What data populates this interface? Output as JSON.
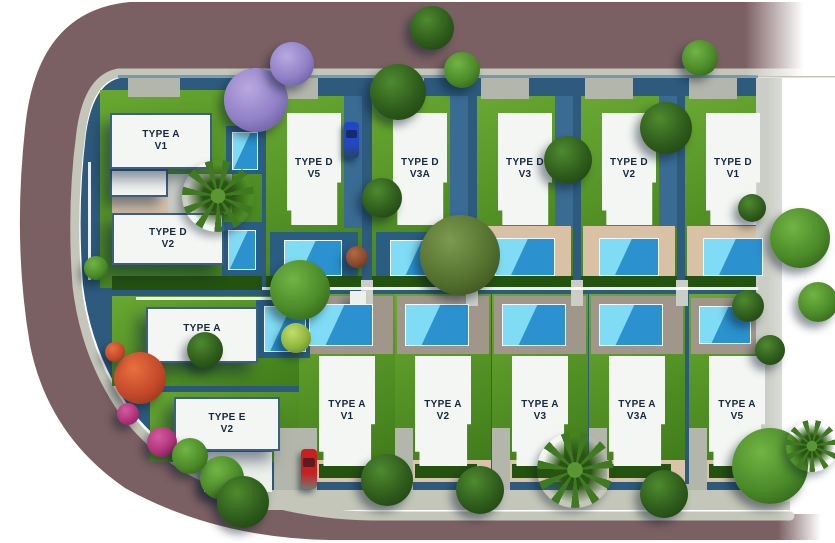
{
  "scene": {
    "width": 835,
    "height": 543,
    "colors": {
      "road": "#7b6063",
      "curb": "#c3c6b9",
      "parcel": "#2d5a7d",
      "lawn_light": "#69a832",
      "lawn_dark": "#3f7c1a",
      "hedge": "#24520f",
      "deckDark": "#2a5d82",
      "deckBeige": "#d8c1a5",
      "deckTaupe": "#a1968a",
      "sand": "#d9c4aa",
      "path": "#b3b7ab",
      "pathLight": "#cbcec6",
      "sidewalk": "#c3c6b9",
      "sidestrip": "#3a6b93",
      "pool_light": "#7fdcf4",
      "pool_deep": "#2b92cf",
      "fence": "#ffffff",
      "highlight": "#5f8aa9",
      "annex": "#eef0ec",
      "roof": "#f4f6f4",
      "roof_outline": "#3c607f",
      "label_text": "#16293c"
    },
    "tree_palettes": {
      "dark": {
        "light": "#4e8a2e",
        "base": "#2e5c1c",
        "deep": "#1d3f10"
      },
      "mid": {
        "light": "#72b445",
        "base": "#4b8a28",
        "deep": "#2c5a14"
      },
      "olive": {
        "light": "#7d9a4f",
        "base": "#55712f",
        "deep": "#36491c"
      },
      "yellow": {
        "light": "#c2dd6e",
        "base": "#8fb63a",
        "deep": "#5d7c1f"
      },
      "purple": {
        "light": "#b9a9e0",
        "base": "#8f7fc6",
        "deep": "#5e5390"
      },
      "redorange": {
        "light": "#e8703f",
        "base": "#c4492a",
        "deep": "#8a2f1a"
      },
      "magenta": {
        "light": "#d45ba1",
        "base": "#b0337a",
        "deep": "#7a1f53"
      },
      "redbrown": {
        "light": "#b06a43",
        "base": "#8a4a2e",
        "deep": "#5c2e1a"
      },
      "palm": {
        "light": "#5c9633",
        "base": "#3f7a22",
        "deep": "#2a5413"
      }
    }
  },
  "villas": [
    {
      "id": "a-v1-nw",
      "l1": "TYPE A",
      "l2": "V1",
      "x": 110,
      "y": 113,
      "w": 102,
      "h": 56,
      "outlined": true,
      "wing": {
        "x": 110,
        "y": 169,
        "w": 58,
        "h": 28
      }
    },
    {
      "id": "d-v2-w",
      "l1": "TYPE D",
      "l2": "V2",
      "x": 112,
      "y": 213,
      "w": 112,
      "h": 52,
      "outlined": true
    },
    {
      "id": "a-v1-w",
      "l1": "TYPE A",
      "l2": "V1",
      "x": 146,
      "y": 307,
      "w": 112,
      "h": 56,
      "outlined": true
    },
    {
      "id": "e-v2",
      "l1": "TYPE E",
      "l2": "V2",
      "x": 174,
      "y": 397,
      "w": 106,
      "h": 54,
      "outlined": true
    },
    {
      "id": "d-v5",
      "l1": "TYPE D",
      "l2": "V5",
      "x": 287,
      "y": 113,
      "w": 54,
      "h": 112,
      "clip": "top"
    },
    {
      "id": "d-v3a",
      "l1": "TYPE D",
      "l2": "V3A",
      "x": 393,
      "y": 113,
      "w": 54,
      "h": 112,
      "clip": "top"
    },
    {
      "id": "d-v3",
      "l1": "TYPE D",
      "l2": "V3",
      "x": 498,
      "y": 113,
      "w": 54,
      "h": 112,
      "clip": "top"
    },
    {
      "id": "d-v2",
      "l1": "TYPE D",
      "l2": "V2",
      "x": 602,
      "y": 113,
      "w": 54,
      "h": 112,
      "clip": "top"
    },
    {
      "id": "d-v1",
      "l1": "TYPE D",
      "l2": "V1",
      "x": 706,
      "y": 113,
      "w": 54,
      "h": 112,
      "clip": "top"
    },
    {
      "id": "a-v1-s",
      "l1": "TYPE A",
      "l2": "V1",
      "x": 319,
      "y": 356,
      "w": 56,
      "h": 110,
      "clip": "bottom"
    },
    {
      "id": "a-v2",
      "l1": "TYPE A",
      "l2": "V2",
      "x": 415,
      "y": 356,
      "w": 56,
      "h": 110,
      "clip": "bottom"
    },
    {
      "id": "a-v3",
      "l1": "TYPE A",
      "l2": "V3",
      "x": 512,
      "y": 356,
      "w": 56,
      "h": 110,
      "clip": "bottom"
    },
    {
      "id": "a-v3a",
      "l1": "TYPE A",
      "l2": "V3A",
      "x": 609,
      "y": 356,
      "w": 56,
      "h": 110,
      "clip": "bottom"
    },
    {
      "id": "a-v5",
      "l1": "TYPE A",
      "l2": "V5",
      "x": 709,
      "y": 356,
      "w": 56,
      "h": 110,
      "clip": "bottom"
    }
  ],
  "rects": [
    {
      "k": "lawn",
      "x": 100,
      "y": 90,
      "w": 162,
      "h": 198
    },
    {
      "k": "lawn",
      "x": 266,
      "y": 96,
      "w": 96,
      "h": 192
    },
    {
      "k": "lawn",
      "x": 372,
      "y": 96,
      "w": 96,
      "h": 192
    },
    {
      "k": "lawn",
      "x": 477,
      "y": 96,
      "w": 96,
      "h": 192
    },
    {
      "k": "lawn",
      "x": 581,
      "y": 96,
      "w": 96,
      "h": 192
    },
    {
      "k": "lawn",
      "x": 685,
      "y": 96,
      "w": 96,
      "h": 192
    },
    {
      "k": "lawn",
      "x": 112,
      "y": 296,
      "w": 198,
      "h": 90
    },
    {
      "k": "lawn",
      "x": 150,
      "y": 392,
      "w": 160,
      "h": 70
    },
    {
      "k": "lawn",
      "x": 299,
      "y": 294,
      "w": 96,
      "h": 170
    },
    {
      "k": "lawn",
      "x": 395,
      "y": 294,
      "w": 96,
      "h": 170
    },
    {
      "k": "lawn",
      "x": 492,
      "y": 294,
      "w": 96,
      "h": 170
    },
    {
      "k": "lawn",
      "x": 589,
      "y": 294,
      "w": 96,
      "h": 170
    },
    {
      "k": "lawn",
      "x": 689,
      "y": 294,
      "w": 92,
      "h": 170
    },
    {
      "k": "sand",
      "x": 112,
      "y": 172,
      "w": 56,
      "h": 42
    },
    {
      "k": "pathLight",
      "x": 168,
      "y": 174,
      "w": 64,
      "h": 40
    },
    {
      "k": "sidestrip",
      "x": 344,
      "y": 96,
      "w": 18,
      "h": 132
    },
    {
      "k": "sidestrip",
      "x": 450,
      "y": 96,
      "w": 18,
      "h": 132
    },
    {
      "k": "sidestrip",
      "x": 555,
      "y": 96,
      "w": 18,
      "h": 132
    },
    {
      "k": "sidestrip",
      "x": 659,
      "y": 96,
      "w": 18,
      "h": 132
    },
    {
      "k": "deckDark",
      "x": 270,
      "y": 232,
      "w": 88,
      "h": 52
    },
    {
      "k": "deckDark",
      "x": 376,
      "y": 232,
      "w": 88,
      "h": 52
    },
    {
      "k": "deckBeige",
      "x": 479,
      "y": 226,
      "w": 92,
      "h": 60
    },
    {
      "k": "deckBeige",
      "x": 583,
      "y": 226,
      "w": 92,
      "h": 60
    },
    {
      "k": "deckBeige",
      "x": 687,
      "y": 226,
      "w": 92,
      "h": 60
    },
    {
      "k": "deckTaupe",
      "x": 301,
      "y": 296,
      "w": 92,
      "h": 58
    },
    {
      "k": "deckTaupe",
      "x": 397,
      "y": 296,
      "w": 92,
      "h": 58
    },
    {
      "k": "deckTaupe",
      "x": 494,
      "y": 296,
      "w": 92,
      "h": 58
    },
    {
      "k": "deckTaupe",
      "x": 591,
      "y": 296,
      "w": 92,
      "h": 58
    },
    {
      "k": "deckTaupe",
      "x": 691,
      "y": 298,
      "w": 88,
      "h": 56
    },
    {
      "k": "deckDark",
      "x": 226,
      "y": 126,
      "w": 36,
      "h": 48
    },
    {
      "k": "deckDark",
      "x": 222,
      "y": 222,
      "w": 40,
      "h": 54
    },
    {
      "k": "deckDark",
      "x": 256,
      "y": 300,
      "w": 54,
      "h": 58
    },
    {
      "k": "sand",
      "x": 299,
      "y": 460,
      "w": 96,
      "h": 22
    },
    {
      "k": "sand",
      "x": 395,
      "y": 460,
      "w": 96,
      "h": 22
    },
    {
      "k": "sand",
      "x": 492,
      "y": 460,
      "w": 96,
      "h": 22
    },
    {
      "k": "sand",
      "x": 589,
      "y": 460,
      "w": 96,
      "h": 22
    },
    {
      "k": "sand",
      "x": 689,
      "y": 460,
      "w": 92,
      "h": 22
    },
    {
      "k": "hedge",
      "x": 266,
      "y": 276,
      "w": 96,
      "h": 14
    },
    {
      "k": "hedge",
      "x": 372,
      "y": 276,
      "w": 96,
      "h": 14
    },
    {
      "k": "hedge",
      "x": 477,
      "y": 276,
      "w": 96,
      "h": 14
    },
    {
      "k": "hedge",
      "x": 581,
      "y": 276,
      "w": 96,
      "h": 14
    },
    {
      "k": "hedge",
      "x": 685,
      "y": 276,
      "w": 96,
      "h": 14
    },
    {
      "k": "hedge",
      "x": 112,
      "y": 276,
      "w": 150,
      "h": 14
    },
    {
      "k": "hedge",
      "x": 319,
      "y": 464,
      "w": 62,
      "h": 14
    },
    {
      "k": "hedge",
      "x": 415,
      "y": 464,
      "w": 62,
      "h": 14
    },
    {
      "k": "hedge",
      "x": 512,
      "y": 464,
      "w": 62,
      "h": 14
    },
    {
      "k": "hedge",
      "x": 609,
      "y": 464,
      "w": 62,
      "h": 14
    },
    {
      "k": "hedge",
      "x": 709,
      "y": 464,
      "w": 58,
      "h": 14
    },
    {
      "k": "path",
      "x": 270,
      "y": 77,
      "w": 48,
      "h": 22
    },
    {
      "k": "path",
      "x": 376,
      "y": 77,
      "w": 48,
      "h": 22
    },
    {
      "k": "path",
      "x": 481,
      "y": 77,
      "w": 48,
      "h": 22
    },
    {
      "k": "path",
      "x": 585,
      "y": 77,
      "w": 48,
      "h": 22
    },
    {
      "k": "path",
      "x": 689,
      "y": 77,
      "w": 48,
      "h": 22
    },
    {
      "k": "path",
      "x": 128,
      "y": 77,
      "w": 52,
      "h": 20
    },
    {
      "k": "pathLight",
      "x": 361,
      "y": 280,
      "w": 12,
      "h": 26
    },
    {
      "k": "pathLight",
      "x": 466,
      "y": 280,
      "w": 12,
      "h": 26
    },
    {
      "k": "pathLight",
      "x": 571,
      "y": 280,
      "w": 12,
      "h": 26
    },
    {
      "k": "pathLight",
      "x": 676,
      "y": 280,
      "w": 12,
      "h": 26
    },
    {
      "k": "path",
      "x": 385,
      "y": 484,
      "w": 20,
      "h": 10
    },
    {
      "k": "path",
      "x": 482,
      "y": 484,
      "w": 20,
      "h": 10
    },
    {
      "k": "path",
      "x": 579,
      "y": 484,
      "w": 20,
      "h": 10
    },
    {
      "k": "path",
      "x": 676,
      "y": 484,
      "w": 20,
      "h": 10
    },
    {
      "k": "path",
      "x": 299,
      "y": 428,
      "w": 18,
      "h": 76
    },
    {
      "k": "path",
      "x": 395,
      "y": 428,
      "w": 18,
      "h": 76
    },
    {
      "k": "path",
      "x": 492,
      "y": 428,
      "w": 18,
      "h": 76
    },
    {
      "k": "path",
      "x": 589,
      "y": 428,
      "w": 18,
      "h": 76
    },
    {
      "k": "path",
      "x": 689,
      "y": 428,
      "w": 18,
      "h": 76
    },
    {
      "k": "path",
      "x": 274,
      "y": 428,
      "w": 32,
      "h": 76
    },
    {
      "k": "pathLight",
      "x": 756,
      "y": 78,
      "w": 26,
      "h": 430
    },
    {
      "k": "sidewalk",
      "x": 258,
      "y": 490,
      "w": 532,
      "h": 20
    },
    {
      "k": "annex",
      "x": 204,
      "y": 452,
      "w": 68,
      "h": 40
    },
    {
      "k": "annex",
      "x": 350,
      "y": 291,
      "w": 16,
      "h": 14
    },
    {
      "k": "pool",
      "x": 284,
      "y": 240,
      "w": 58,
      "h": 36
    },
    {
      "k": "pool",
      "x": 390,
      "y": 240,
      "w": 58,
      "h": 36
    },
    {
      "k": "pool",
      "x": 495,
      "y": 238,
      "w": 60,
      "h": 38
    },
    {
      "k": "pool",
      "x": 599,
      "y": 238,
      "w": 60,
      "h": 38
    },
    {
      "k": "pool",
      "x": 703,
      "y": 238,
      "w": 60,
      "h": 38
    },
    {
      "k": "pool",
      "x": 309,
      "y": 304,
      "w": 64,
      "h": 42
    },
    {
      "k": "pool",
      "x": 405,
      "y": 304,
      "w": 64,
      "h": 42
    },
    {
      "k": "pool",
      "x": 502,
      "y": 304,
      "w": 64,
      "h": 42
    },
    {
      "k": "pool",
      "x": 599,
      "y": 304,
      "w": 64,
      "h": 42
    },
    {
      "k": "pool",
      "x": 699,
      "y": 306,
      "w": 52,
      "h": 38
    },
    {
      "k": "pool",
      "x": 232,
      "y": 132,
      "w": 26,
      "h": 38
    },
    {
      "k": "pool",
      "x": 228,
      "y": 230,
      "w": 28,
      "h": 40
    },
    {
      "k": "pool",
      "x": 264,
      "y": 306,
      "w": 42,
      "h": 46
    },
    {
      "k": "fence",
      "x": 262,
      "y": 287,
      "w": 496,
      "h": 3
    },
    {
      "k": "fence",
      "x": 136,
      "y": 297,
      "w": 176,
      "h": 3
    },
    {
      "k": "fence",
      "x": 88,
      "y": 162,
      "w": 3,
      "h": 118
    },
    {
      "k": "highlight",
      "x": 118,
      "y": 75,
      "w": 640,
      "h": 3
    }
  ],
  "trees": [
    {
      "p": "purple",
      "x": 256,
      "y": 100,
      "r": 32
    },
    {
      "p": "purple",
      "x": 292,
      "y": 64,
      "r": 22
    },
    {
      "p": "dark",
      "x": 398,
      "y": 92,
      "r": 28
    },
    {
      "p": "dark",
      "x": 432,
      "y": 28,
      "r": 22
    },
    {
      "p": "mid",
      "x": 462,
      "y": 70,
      "r": 18
    },
    {
      "p": "mid",
      "x": 700,
      "y": 58,
      "r": 18
    },
    {
      "p": "dark",
      "x": 568,
      "y": 160,
      "r": 24
    },
    {
      "p": "dark",
      "x": 666,
      "y": 128,
      "r": 26
    },
    {
      "p": "dark",
      "x": 382,
      "y": 198,
      "r": 20
    },
    {
      "p": "olive",
      "x": 460,
      "y": 255,
      "r": 40
    },
    {
      "p": "mid",
      "x": 300,
      "y": 290,
      "r": 30
    },
    {
      "p": "redbrown",
      "x": 357,
      "y": 257,
      "r": 11
    },
    {
      "p": "yellow",
      "x": 296,
      "y": 338,
      "r": 15
    },
    {
      "p": "mid",
      "x": 800,
      "y": 238,
      "r": 30
    },
    {
      "p": "mid",
      "x": 818,
      "y": 302,
      "r": 20
    },
    {
      "p": "dark",
      "x": 748,
      "y": 306,
      "r": 16
    },
    {
      "p": "dark",
      "x": 752,
      "y": 208,
      "r": 14
    },
    {
      "p": "dark",
      "x": 770,
      "y": 350,
      "r": 15
    },
    {
      "p": "dark",
      "x": 387,
      "y": 480,
      "r": 26
    },
    {
      "p": "dark",
      "x": 480,
      "y": 490,
      "r": 24
    },
    {
      "p": "dark",
      "x": 664,
      "y": 494,
      "r": 24
    },
    {
      "p": "mid",
      "x": 770,
      "y": 466,
      "r": 38
    },
    {
      "p": "redorange",
      "x": 140,
      "y": 378,
      "r": 26
    },
    {
      "p": "redorange",
      "x": 115,
      "y": 352,
      "r": 10
    },
    {
      "p": "dark",
      "x": 205,
      "y": 350,
      "r": 18
    },
    {
      "p": "magenta",
      "x": 162,
      "y": 442,
      "r": 15
    },
    {
      "p": "magenta",
      "x": 128,
      "y": 414,
      "r": 11
    },
    {
      "p": "mid",
      "x": 222,
      "y": 478,
      "r": 22
    },
    {
      "p": "dark",
      "x": 243,
      "y": 502,
      "r": 26
    },
    {
      "p": "mid",
      "x": 190,
      "y": 456,
      "r": 18
    },
    {
      "p": "mid",
      "x": 96,
      "y": 268,
      "r": 12
    }
  ],
  "palms": [
    {
      "x": 218,
      "y": 196,
      "r": 36
    },
    {
      "x": 575,
      "y": 470,
      "r": 38
    },
    {
      "x": 812,
      "y": 446,
      "r": 26
    }
  ],
  "cars": [
    {
      "name": "blue-car",
      "x": 344,
      "y": 122,
      "w": 15,
      "h": 36,
      "color": "#2247c4"
    },
    {
      "name": "red-car",
      "x": 301,
      "y": 449,
      "w": 16,
      "h": 40,
      "color": "#c81f1f"
    }
  ]
}
